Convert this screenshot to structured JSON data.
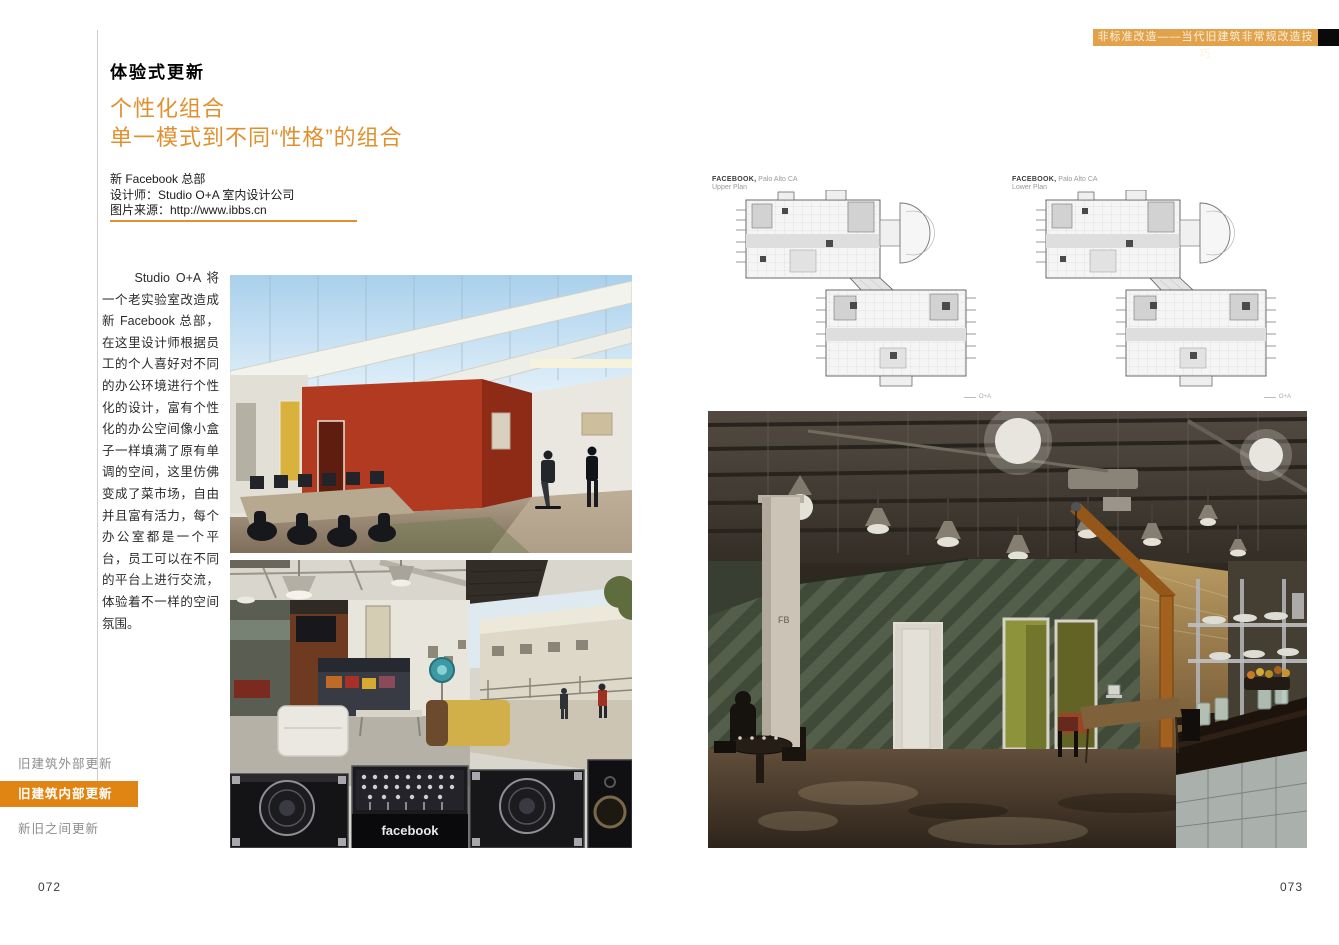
{
  "header": {
    "text": "非标准改造——当代旧建筑非常规改造技巧"
  },
  "left": {
    "section_title": "体验式更新",
    "heading_line1": "个性化组合",
    "heading_line2": "单一模式到不同“性格”的组合",
    "credit": {
      "line1": "新 Facebook 总部",
      "line2": "设计师：Studio O+A 室内设计公司",
      "line3": "图片来源：http://www.ibbs.cn"
    },
    "body": "Studio O+A 将一个老实验室改造成新 Facebook 总部，在这里设计师根据员工的个人喜好对不同的办公环境进行个性化的设计，富有个性化的办公空间像小盒子一样填满了原有单调的空间，这里仿佛变成了菜市场，自由并且富有活力，每个办公室都是一个平台，员工可以在不同的平台上进行交流，体验着不一样的空间氛围。"
  },
  "sidebar": {
    "items": [
      {
        "label": "旧建筑外部更新",
        "active": false
      },
      {
        "label": "旧建筑内部更新",
        "active": true
      },
      {
        "label": "新旧之间更新",
        "active": false
      }
    ]
  },
  "plans": [
    {
      "title_bold": "FACEBOOK,",
      "title_rest": "Palo Alto CA",
      "subtitle": "Upper Plan",
      "note": "O+A"
    },
    {
      "title_bold": "FACEBOOK,",
      "title_rest": "Palo Alto CA",
      "subtitle": "Lower Plan",
      "note": "O+A"
    }
  ],
  "photos": {
    "dj_case_label": "facebook",
    "column_label": "FB"
  },
  "pager": {
    "left": "072",
    "right": "073"
  },
  "colors": {
    "accent_orange": "#E0912F",
    "tab_orange": "#E08414",
    "header_bar_orange": "#E2A24B"
  }
}
